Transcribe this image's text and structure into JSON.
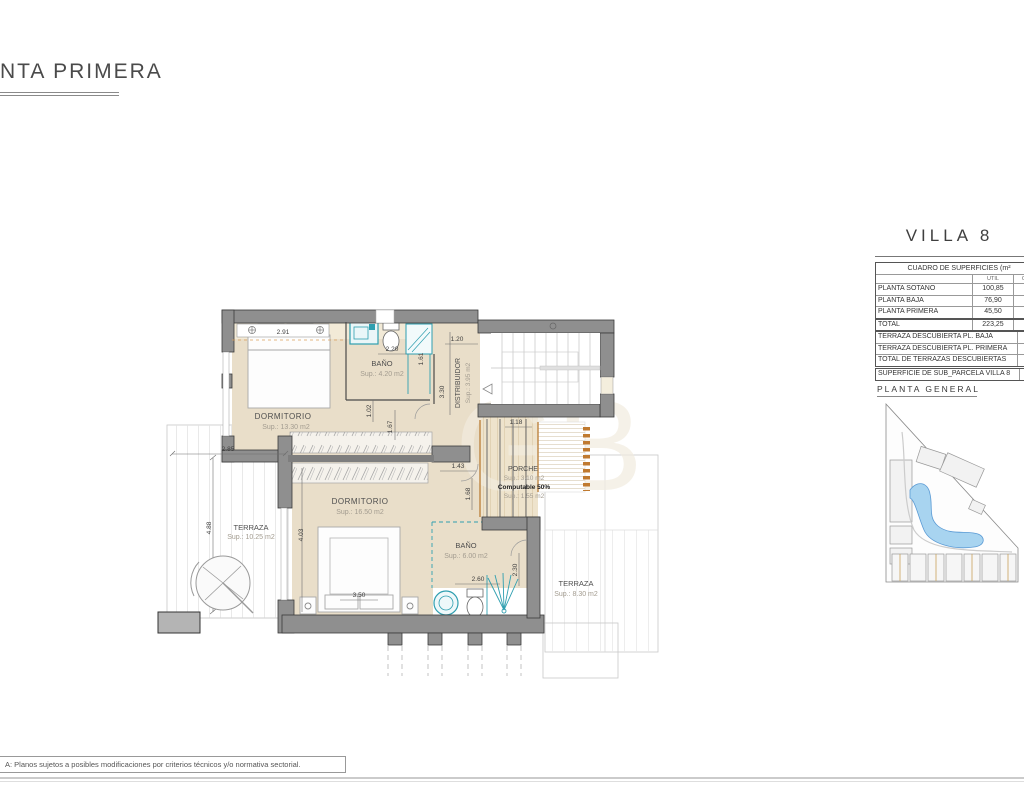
{
  "header": {
    "title": "NTA PRIMERA"
  },
  "plan": {
    "rooms": {
      "dorm1_name": "DORMITORIO",
      "dorm1_sup": "Sup.: 13.30 m2",
      "bano1_name": "BAÑO",
      "bano1_sup": "Sup.: 4.20 m2",
      "distribuidor_name": "DISTRIBUIDOR",
      "distribuidor_sup": "Sup.: 3.95 m2",
      "dorm2_name": "DORMITORIO",
      "dorm2_sup": "Sup.: 16.50 m2",
      "bano2_name": "BAÑO",
      "bano2_sup": "Sup.: 6.00 m2",
      "porche_name": "PORCHE",
      "porche_sup": "Sup.: 3.10 m2",
      "porche_computable": "Computable 50%",
      "porche_sup2": "Sup.: 1.55 m2",
      "terraza_left_name": "TERRAZA",
      "terraza_left_sup": "Sup.: 10.25 m2",
      "terraza_right_name": "TERRAZA",
      "terraza_right_sup": "Sup.: 8.30 m2"
    },
    "dims": {
      "d291": "2.91",
      "d220": "2.20",
      "d102": "1.02",
      "d167": "1.67",
      "d161": "1.61",
      "d120": "1.20",
      "d330": "3.30",
      "d118": "1.18",
      "d143": "1.43",
      "d168": "1.68",
      "d403": "4.03",
      "d350": "3.50",
      "d260": "2.60",
      "d230": "2.30",
      "d285": "2.85",
      "d488": "4.88"
    }
  },
  "panel": {
    "villa_title": "VILLA 8",
    "surfaces_table": {
      "title": "CUADRO DE SUPERFICIES (m²",
      "col_util": "UTIL",
      "col_con": "CON",
      "rows": [
        {
          "label": "PLANTA SOTANO",
          "util": "100,85",
          "con": "1"
        },
        {
          "label": "PLANTA BAJA",
          "util": "76,90",
          "con": ""
        },
        {
          "label": "PLANTA PRIMERA",
          "util": "45,50",
          "con": ""
        },
        {
          "label": "TOTAL",
          "util": "223,25",
          "con": "2"
        }
      ]
    },
    "terraces_table": {
      "rows": [
        {
          "label": "TERRAZA DESCUBIERTA PL. BAJA",
          "value": "1"
        },
        {
          "label": "TERRAZA DESCUBIERTA PL. PRIMERA",
          "value": ""
        },
        {
          "label": "TOTAL DE TERRAZAS DESCUBIERTAS",
          "value": ""
        }
      ]
    },
    "parcel_row": {
      "label": "SUPERFICIE DE SUB_PARCELA VILLA 8",
      "value": "2"
    },
    "site_plan_title": "PLANTA GENERAL"
  },
  "footer": {
    "note": "A: Planos sujetos a posibles modificaciones por criterios técnicos y/o normativa sectorial."
  },
  "colors": {
    "wall": "#8f8f8f",
    "room_fill": "#e9dec9",
    "fixture_teal": "#2f9fb0",
    "pergola_orange": "#c07a30",
    "pool_blue": "#a8d4f0"
  }
}
